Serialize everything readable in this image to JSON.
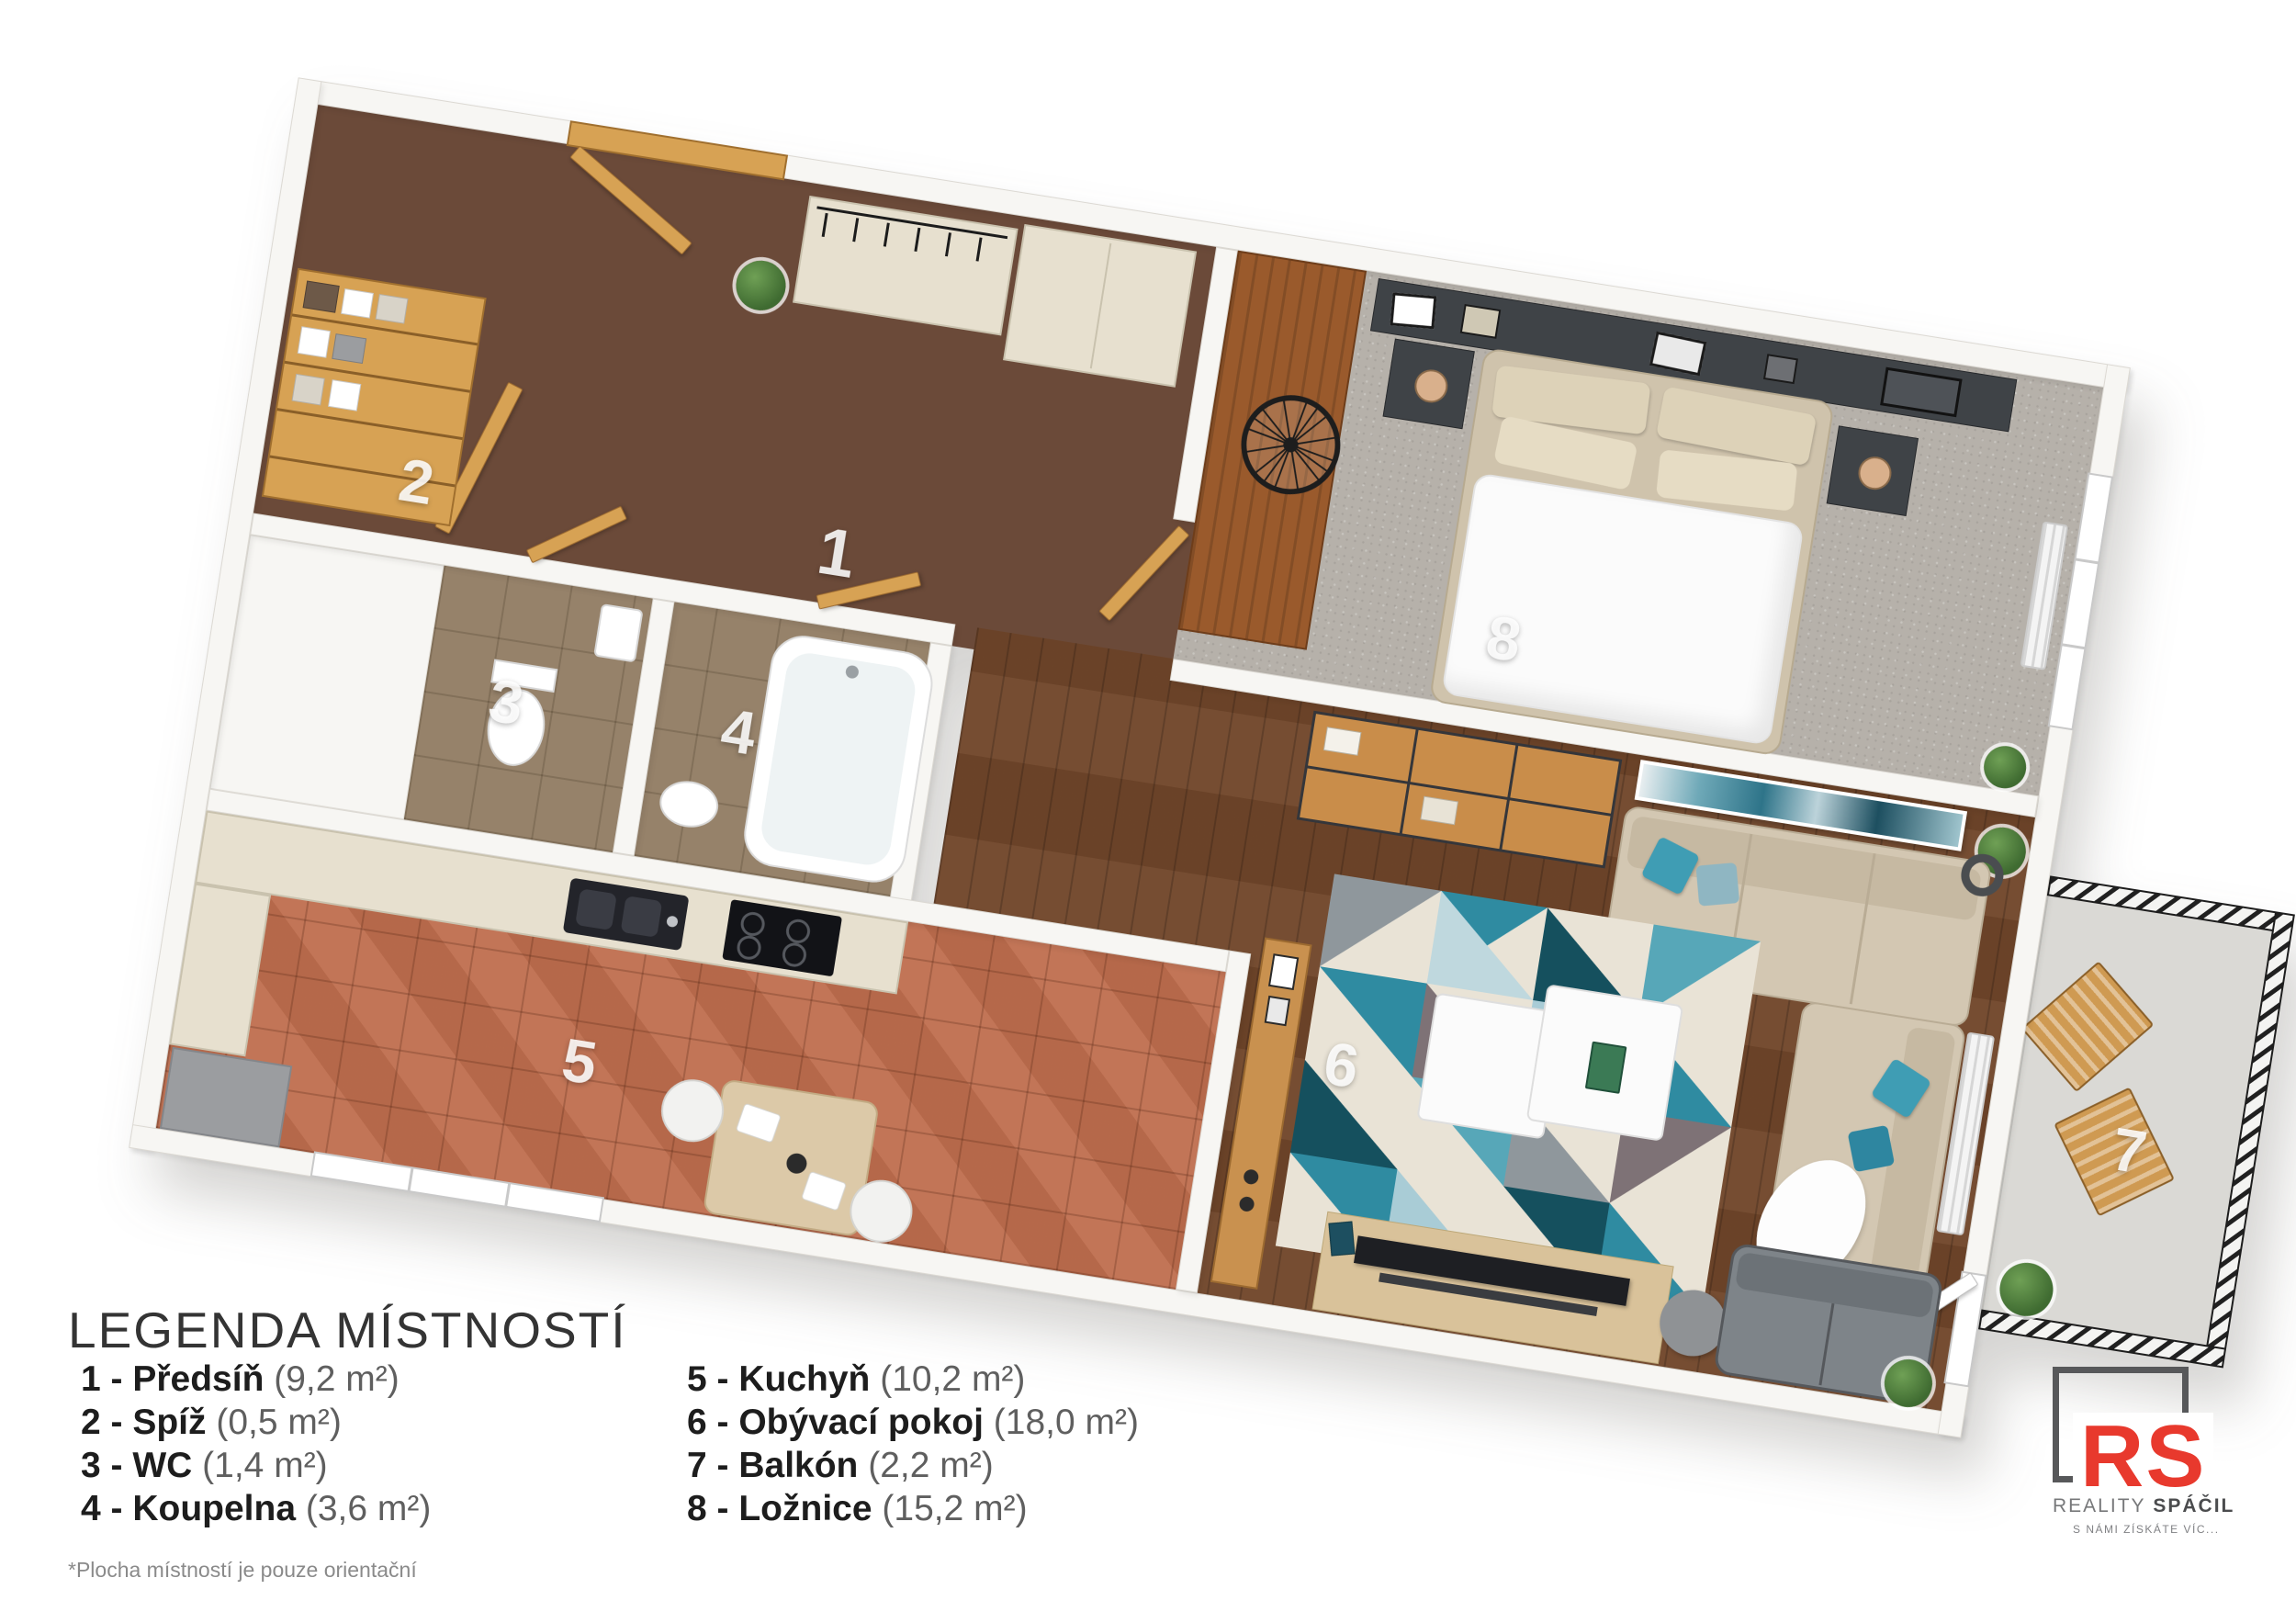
{
  "plan": {
    "rooms": [
      {
        "num": "1",
        "name": "Předsíň"
      },
      {
        "num": "2",
        "name": "Spíž"
      },
      {
        "num": "3",
        "name": "WC"
      },
      {
        "num": "4",
        "name": "Koupelna"
      },
      {
        "num": "5",
        "name": "Kuchyň"
      },
      {
        "num": "6",
        "name": "Obývací pokoj"
      },
      {
        "num": "7",
        "name": "Balkón"
      },
      {
        "num": "8",
        "name": "Ložnice"
      }
    ]
  },
  "legend": {
    "title": "LEGENDA MÍSTNOSTÍ",
    "columns": [
      {
        "items": [
          {
            "label": "1 - Předsíň",
            "area": "(9,2 m²)"
          },
          {
            "label": "2 - Spíž",
            "area": "(0,5 m²)"
          },
          {
            "label": "3 - WC",
            "area": "(1,4 m²)"
          },
          {
            "label": "4 - Koupelna",
            "area": "(3,6 m²)"
          }
        ]
      },
      {
        "items": [
          {
            "label": "5 - Kuchyň",
            "area": "(10,2 m²)"
          },
          {
            "label": "6 - Obývací pokoj",
            "area": "(18,0 m²)"
          },
          {
            "label": "7 - Balkón",
            "area": "(2,2 m²)"
          },
          {
            "label": "8 - Ložnice",
            "area": "(15,2 m²)"
          }
        ]
      }
    ],
    "footnote": "*Plocha místností je pouze orientační"
  },
  "logo": {
    "monogram": "RS",
    "brand_regular": "REALITY",
    "brand_bold": " SPÁČIL",
    "tagline": "S NÁMI ZÍSKÁTE VÍC...",
    "accent_color": "#e8392d",
    "frame_color": "#57585a"
  },
  "colors": {
    "hall_floor": "#6b4a39",
    "living_floor": "#70462a",
    "kitchen_floor": "#bf6e4e",
    "bath_floor": "#96826a",
    "bedroom_carpet": "#b6b1aa",
    "balcony_floor": "#dad9d5",
    "wall": "#f7f6f3",
    "door_oak": "#d7a254",
    "sofa_beige": "#d3c7b2",
    "pillow_teal": "#3f9db4"
  }
}
